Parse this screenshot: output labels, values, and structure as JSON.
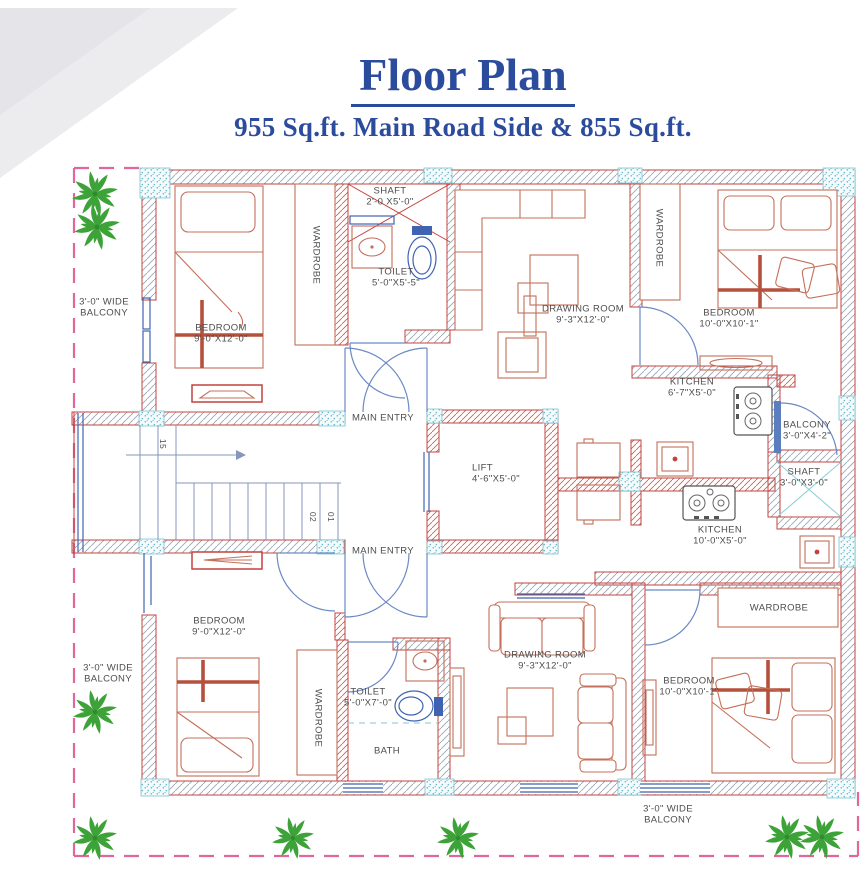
{
  "header": {
    "title": "Floor Plan",
    "subtitle": "955 Sq.ft. Main Road Side & 855 Sq.ft."
  },
  "colors": {
    "title_blue": "#2b4b9c",
    "wall_red": "#c4413c",
    "hatch_grey": "#97a8b8",
    "furniture_orange": "#c4705a",
    "door_blue": "#6b89c4",
    "fixture_blue": "#3f63b0",
    "palm_green": "#3da339",
    "site_boundary_pink": "#e0679b",
    "column_teal": "#7ec3cf"
  },
  "labels": {
    "balcony_tl": {
      "l1": "3'-0\" WIDE",
      "l2": "BALCONY"
    },
    "bedroom_tl": {
      "l1": "BEDROOM",
      "l2": "9'-0\"X12'-0\""
    },
    "wardrobe_tl": {
      "l1": "WARDROBE"
    },
    "shaft_top": {
      "l1": "SHAFT",
      "l2": "2'-0 X5'-0\""
    },
    "toilet_tl": {
      "l1": "TOILET",
      "l2": "5'-0\"X5'-5\""
    },
    "drawing_tr": {
      "l1": "DRAWING ROOM",
      "l2": "9'-3\"X12'-0\""
    },
    "wardrobe_tr": {
      "l1": "WARDROBE"
    },
    "bedroom_tr": {
      "l1": "BEDROOM",
      "l2": "10'-0\"X10'-1\""
    },
    "kitchen_tr": {
      "l1": "KITCHEN",
      "l2": "6'-7\"X5'-0\""
    },
    "main_entry_top": {
      "l1": "MAIN ENTRY"
    },
    "lift": {
      "l1": "LIFT",
      "l2": "4'-6\"X5'-0\""
    },
    "main_entry_bottom": {
      "l1": "MAIN ENTRY"
    },
    "balcony_r": {
      "l1": "BALCONY",
      "l2": "3'-0\"X4'-2\""
    },
    "shaft_r": {
      "l1": "SHAFT",
      "l2": "3'-0\"X3'-0\""
    },
    "kitchen_mid": {
      "l1": "KITCHEN",
      "l2": "10'-0\"X5'-0\""
    },
    "wardrobe_br": {
      "l1": "WARDROBE"
    },
    "bedroom_bl": {
      "l1": "BEDROOM",
      "l2": "9'-0\"X12'-0\""
    },
    "balcony_bl": {
      "l1": "3'-0\" WIDE",
      "l2": "BALCONY"
    },
    "wardrobe_bl": {
      "l1": "WARDROBE"
    },
    "toilet_bl": {
      "l1": "TOILET",
      "l2": "5'-0\"X7'-0\""
    },
    "bath": {
      "l1": "BATH"
    },
    "drawing_b": {
      "l1": "DRAWING ROOM",
      "l2": "9'-3\"X12'-0\""
    },
    "bedroom_br": {
      "l1": "BEDROOM",
      "l2": "10'-0\"X10'-1\""
    },
    "balcony_b": {
      "l1": "3'-0\" WIDE",
      "l2": "BALCONY"
    },
    "stairs": {
      "n15": "15",
      "n02": "02",
      "n01": "01"
    }
  }
}
